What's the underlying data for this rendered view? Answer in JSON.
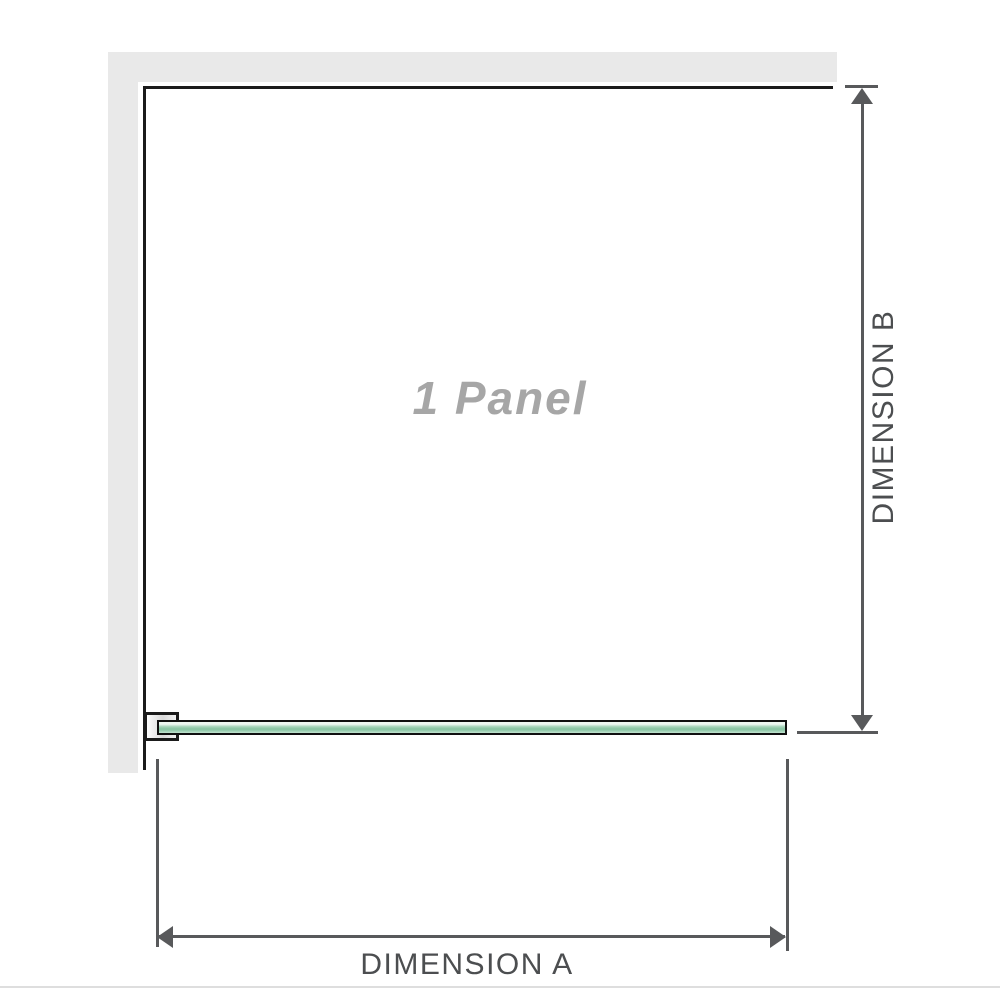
{
  "diagram": {
    "panel_label": "1 Panel",
    "dimension_a_label": "DIMENSION A",
    "dimension_b_label": "DIMENSION B"
  },
  "colors": {
    "wall": "#e9e9e9",
    "outline": "#1b1b1b",
    "dimension_line": "#58595b",
    "dimension_text": "#4c4e50",
    "panel_text": "#a6a6a6",
    "glass_border": "#101010",
    "glass_light": "#eef8f2",
    "glass_mid": "#8cc7a6",
    "glass_soft": "#c2e3d0",
    "divider": "#dedede"
  }
}
